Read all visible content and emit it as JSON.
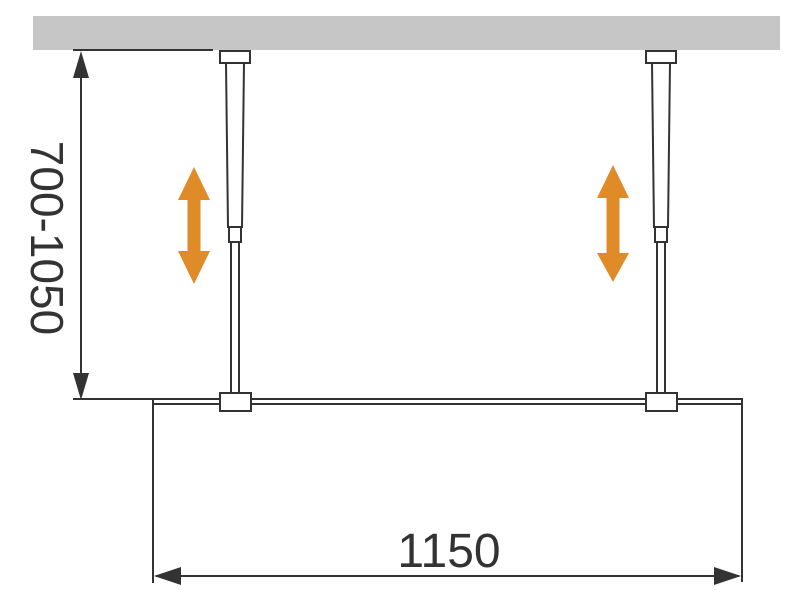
{
  "diagram": {
    "type": "installation-drawing",
    "subject": "walk-in glass screen with two ceiling support rods",
    "dimensions": {
      "height_range_label": "700-1050",
      "width_label": "1150"
    },
    "colors": {
      "ceiling_gray": "#C6C6C6",
      "line_black": "#333333",
      "accent_orange": "#DE8B28",
      "background": "#FFFFFF"
    }
  }
}
